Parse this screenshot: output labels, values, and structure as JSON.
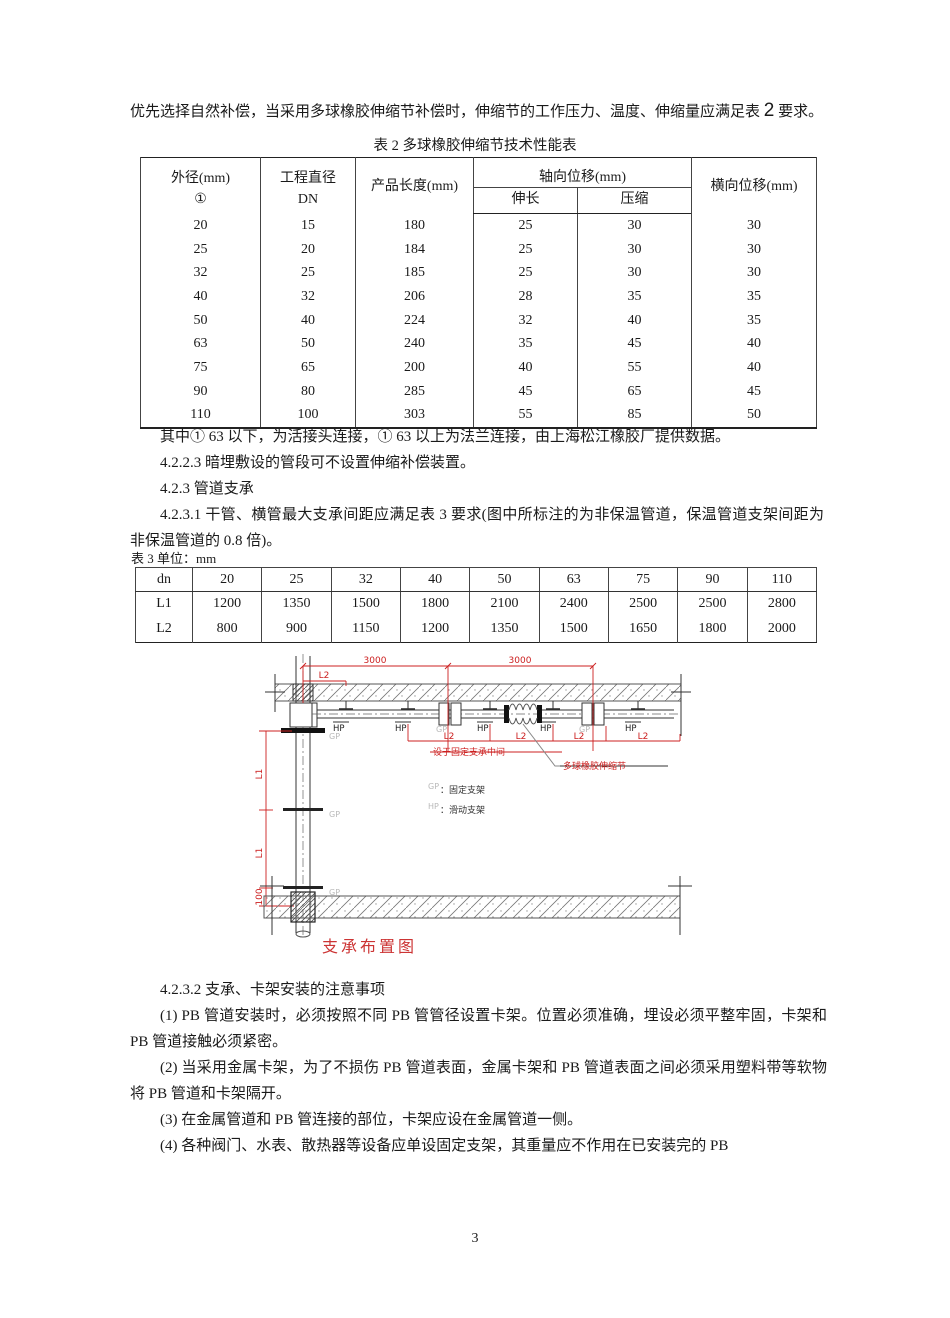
{
  "intro": {
    "pre": "优先选择自然补偿，当采用多球橡胶伸缩节补偿时，伸缩节的工作压力、温度、伸缩量应满足表 ",
    "big": "2",
    "post": " 要求。"
  },
  "table2": {
    "title": "表 2 多球橡胶伸缩节技术性能表",
    "headers": {
      "col1a": "外径(mm)",
      "col1b": "①",
      "col2a": "工程直径",
      "col2b": "DN",
      "col3": "产品长度(mm)",
      "col4": "轴向位移(mm)",
      "col4a": "伸长",
      "col4b": "压缩",
      "col5": "横向位移(mm)"
    },
    "rows": [
      [
        "20",
        "15",
        "180",
        "25",
        "30",
        "30"
      ],
      [
        "25",
        "20",
        "184",
        "25",
        "30",
        "30"
      ],
      [
        "32",
        "25",
        "185",
        "25",
        "30",
        "30"
      ],
      [
        "40",
        "32",
        "206",
        "28",
        "35",
        "35"
      ],
      [
        "50",
        "40",
        "224",
        "32",
        "40",
        "35"
      ],
      [
        "63",
        "50",
        "240",
        "35",
        "45",
        "40"
      ],
      [
        "75",
        "65",
        "200",
        "40",
        "55",
        "40"
      ],
      [
        "90",
        "80",
        "285",
        "45",
        "65",
        "45"
      ],
      [
        "110",
        "100",
        "303",
        "55",
        "85",
        "50"
      ]
    ]
  },
  "notes": {
    "note1": "其中① 63 以下，为活接头连接，① 63 以上为法兰连接，由上海松江橡胶厂提供数据。",
    "s4223": "4.2.2.3 暗埋敷设的管段可不设置伸缩补偿装置。",
    "s423": "4.2.3 管道支承",
    "s4231": "4.2.3.1 干管、横管最大支承间距应满足表 3 要求(图中所标注的为非保温管道，保温管道支架间距为非保温管道的 0.8 倍)。"
  },
  "table3": {
    "caption": "表 3 单位：mm",
    "rows": [
      [
        "dn",
        "20",
        "25",
        "32",
        "40",
        "50",
        "63",
        "75",
        "90",
        "110"
      ],
      [
        "L1",
        "1200",
        "1350",
        "1500",
        "1800",
        "2100",
        "2400",
        "2500",
        "2500",
        "2800"
      ],
      [
        "L2",
        "800",
        "900",
        "1150",
        "1200",
        "1350",
        "1500",
        "1650",
        "1800",
        "2000"
      ]
    ]
  },
  "diagram": {
    "caption": "支承布置图",
    "dims": {
      "d3000": "3000",
      "l2": "L2",
      "l1": "L1",
      "d100": "100"
    },
    "labels": {
      "gp": "GP",
      "hp": "HP",
      "callout_fixed_mid": "设于固定支承中间",
      "callout_joint": "多球橡胶伸缩节"
    },
    "legend": {
      "gp_key": "GP",
      "gp_val": "：固定支架",
      "hp_key": "HP",
      "hp_val": "：滑动支架"
    },
    "colors": {
      "red": "#cc2020",
      "gray": "#b9b9b9"
    }
  },
  "section4232": {
    "title": "4.2.3.2 支承、卡架安装的注意事项",
    "p1": "(1) PB 管道安装时，必须按照不同 PB 管管径设置卡架。位置必须准确，埋设必须平整牢固，卡架和 PB 管道接触必须紧密。",
    "p2": "(2) 当采用金属卡架，为了不损伤 PB 管道表面，金属卡架和 PB 管道表面之间必须采用塑料带等软物将 PB 管道和卡架隔开。",
    "p3": "(3) 在金属管道和 PB 管连接的部位，卡架应设在金属管道一侧。",
    "p4": "(4) 各种阀门、水表、散热器等设备应单设固定支架，其重量应不作用在已安装完的 PB"
  },
  "page": {
    "number": "3"
  }
}
